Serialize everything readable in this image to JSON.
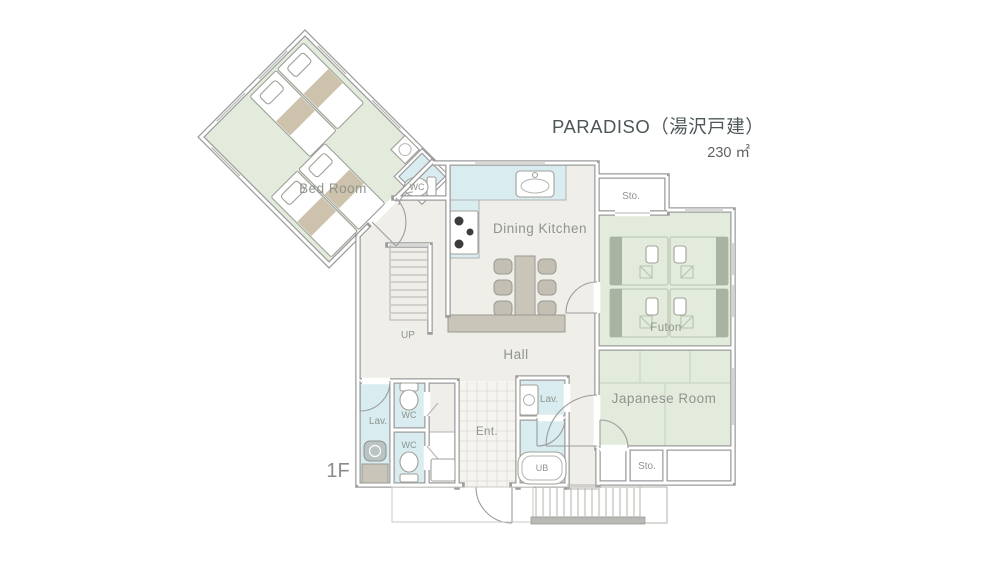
{
  "header": {
    "title": "PARADISO（湯沢戸建）",
    "area": "230 ㎡",
    "floor": "1F"
  },
  "rooms": {
    "bedroom": {
      "label": "Bed Room"
    },
    "wc_bedroom": {
      "label": "WC"
    },
    "dining_kitchen": {
      "label": "Dining Kitchen"
    },
    "storage_top": {
      "label": "Sto."
    },
    "futon": {
      "label": "Futon"
    },
    "japanese_room": {
      "label": "Japanese Room"
    },
    "storage_bottom": {
      "label": "Sto."
    },
    "hall": {
      "label": "Hall"
    },
    "stairs": {
      "label": "UP"
    },
    "lavatory_left": {
      "label": "Lav."
    },
    "wc_upper": {
      "label": "WC"
    },
    "wc_lower": {
      "label": "WC"
    },
    "entrance": {
      "label": "Ent."
    },
    "lavatory_right": {
      "label": "Lav."
    },
    "unit_bath": {
      "label": "UB"
    }
  },
  "palette": {
    "wall_gray": "#9c9c9c",
    "floor_beige": "#efeee9",
    "room_green": "#e3ecdc",
    "wet_blue": "#d9edf1",
    "fixture_gray": "#c9c5b8",
    "tan_blanket": "#cdc2ab",
    "label_gray": "#8f948e",
    "title_gray": "#4d5759"
  }
}
